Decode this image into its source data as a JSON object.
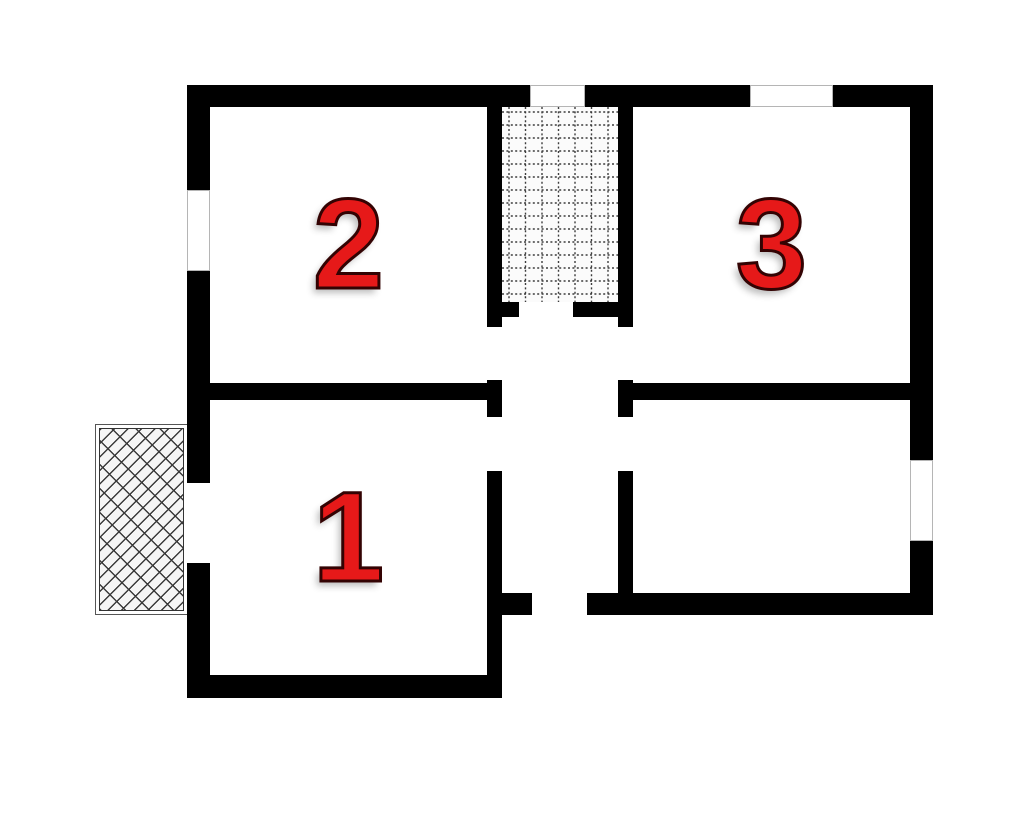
{
  "page": {
    "background": "#ffffff"
  },
  "css_vars": {
    "bg": "#ffffff",
    "wall": "#000000",
    "num-fill": "#e61919",
    "num-outline": "#330303",
    "hatch-line": "#3d3d3d"
  },
  "plan": {
    "type": "floor-plan",
    "rooms": [
      {
        "id": "room-1",
        "label": "1"
      },
      {
        "id": "room-2",
        "label": "2"
      },
      {
        "id": "room-3",
        "label": "3"
      }
    ],
    "areas": {
      "stairs": "stairwell-tiled-area",
      "porch": "entrance-porch",
      "corridor": "central-hallway",
      "store": "unlabeled-room-southeast"
    },
    "openings": {
      "windows": [
        "room2-west-window",
        "stairs-north-window",
        "room3-north-window",
        "store-east-window"
      ],
      "doors": [
        "porch-to-room1-door",
        "stairs-to-hall-door",
        "hall-to-room2-door",
        "hall-to-room1-door",
        "hall-to-room3-door",
        "hall-to-store-door",
        "south-entrance-door"
      ]
    },
    "hatch": {
      "stairs_grid_line_color": "#3d3d3d",
      "porch_brick_line_color": "#3a3a3a"
    }
  }
}
